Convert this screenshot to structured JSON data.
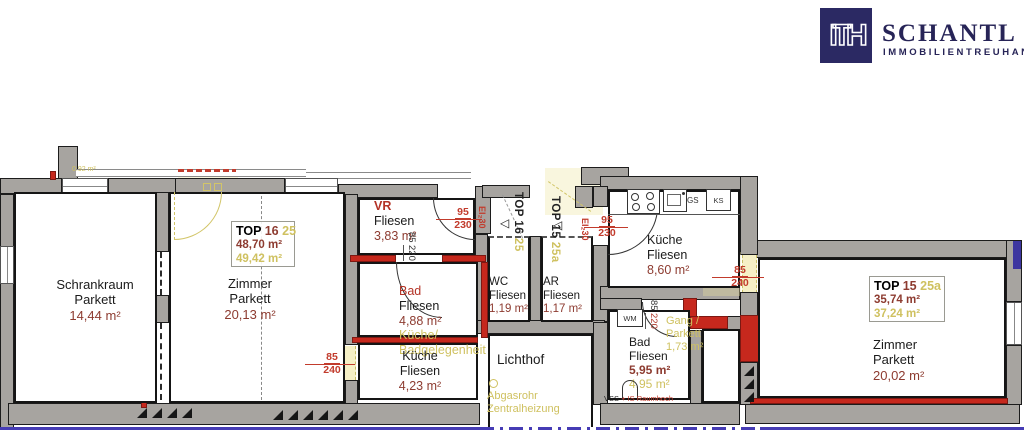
{
  "logo": {
    "mark": "ITH",
    "name": "SCHANTL",
    "tagline": "IMMOBILIENTREUHAND"
  },
  "colors": {
    "brand_navy": "#2b2963",
    "wall_red": "#c6281d",
    "highlight_yellow": "#cfc160",
    "area_maroon": "#8d3b30",
    "plan_blue": "#463cb5"
  },
  "units": {
    "top16": {
      "label": "TOP",
      "number": "16",
      "suffix": "25",
      "area": "48,70 m²",
      "area_alt": "49,42 m²",
      "door_title": "TOP 16"
    },
    "top15": {
      "label": "TOP",
      "number": "15",
      "suffix": "25a",
      "area": "35,74 m²",
      "area_alt": "37,24 m²",
      "door_title": "TOP 15"
    }
  },
  "rooms": {
    "schrankraum": {
      "name": "Schrankraum",
      "floor": "Parkett",
      "area": "14,44 m²"
    },
    "zimmer16": {
      "name": "Zimmer",
      "floor": "Parkett",
      "area": "20,13 m²"
    },
    "vr": {
      "name": "VR",
      "floor": "Fliesen",
      "area": "3,83 m²"
    },
    "bad16": {
      "name": "Bad",
      "floor": "Fliesen",
      "area": "4,88 m²",
      "alt1": "Küche/",
      "alt2": "Badgelegenheit"
    },
    "kueche16": {
      "name": "Küche",
      "floor": "Fliesen",
      "area": "4,23 m²"
    },
    "wc": {
      "name": "WC",
      "floor": "Fliesen",
      "area": "1,19 m²"
    },
    "ar": {
      "name": "AR",
      "floor": "Fliesen",
      "area": "1,17 m²"
    },
    "lichthof": {
      "name": "Lichthof",
      "note1": "Abgasrohr",
      "note2": "Zentralheizung"
    },
    "kueche15": {
      "name": "Küche",
      "floor": "Fliesen",
      "area": "8,60 m²"
    },
    "bad15": {
      "name": "Bad",
      "floor": "Fliesen",
      "area": "5,95 m²",
      "area_alt": "4,95 m²"
    },
    "gang": {
      "name": "Gang /",
      "floor": "Parkett",
      "area": "1,73 m²"
    },
    "zimmer15": {
      "name": "Zimmer",
      "floor": "Parkett",
      "area": "20,02 m²"
    }
  },
  "dims": {
    "w95": "95",
    "h230": "230",
    "w85": "85",
    "h220": "220",
    "h240": "240",
    "fire": "EI₂30"
  },
  "appliances": {
    "wm": "WM",
    "gs": "GS",
    "ks": "KS"
  },
  "annotations": {
    "tiny_area": "0.92 m²",
    "vss": "VSS",
    "vss_note": "+ IS Raumhoch"
  }
}
